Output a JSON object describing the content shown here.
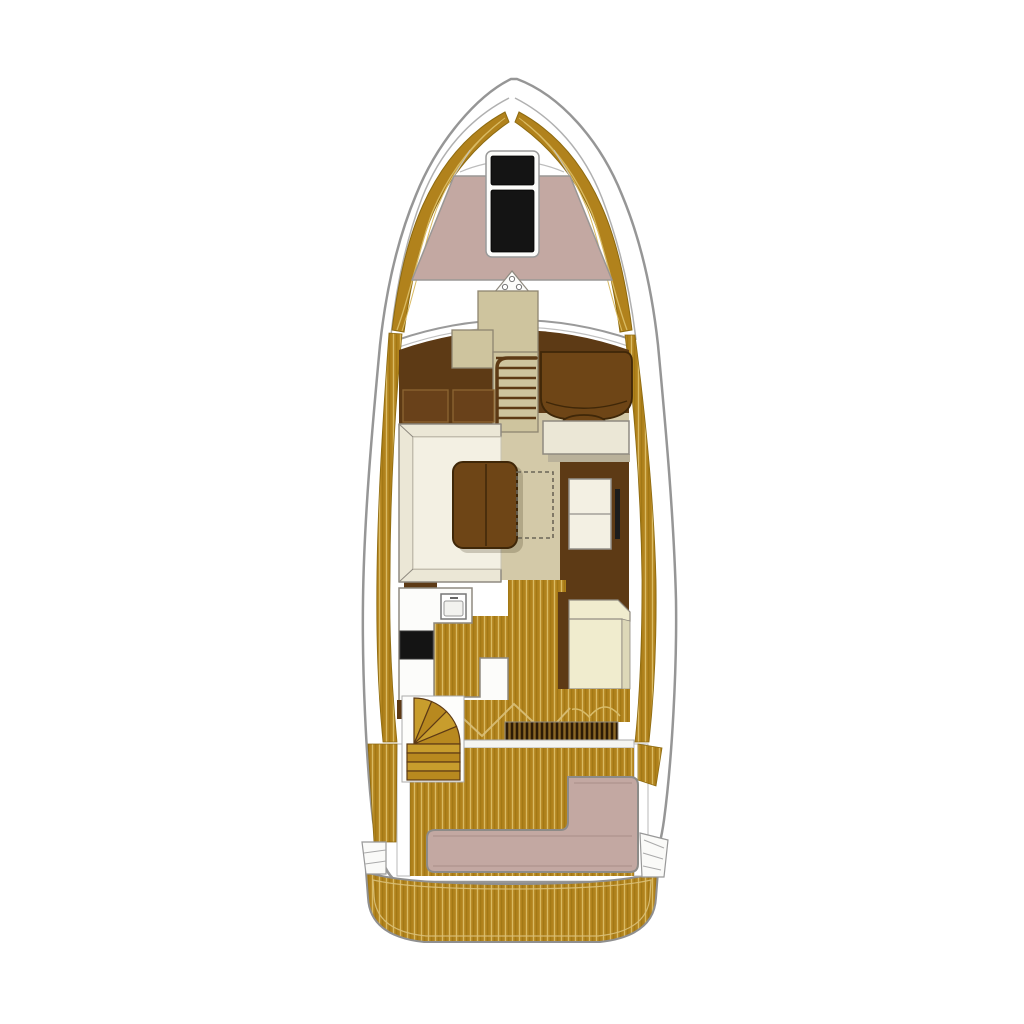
{
  "diagram": {
    "type": "yacht-deck-plan",
    "title": "Motor yacht top-view deck floor plan",
    "areas": {
      "foredeck": {
        "label": "Foredeck",
        "features": [
          "bow sunpad",
          "two deck hatches",
          "anchor deck fitting",
          "teak bow trim"
        ]
      },
      "helm": {
        "label": "Helm area",
        "features": [
          "helm seat with footrest",
          "companionway stairs to lower deck",
          "port cabinets",
          "console"
        ]
      },
      "salon": {
        "label": "Salon",
        "features": [
          "U-shaped sofa",
          "wooden table",
          "dashed table extension",
          "sideboard",
          "starboard bench seat"
        ]
      },
      "galley": {
        "label": "Galley",
        "features": [
          "counter with sink",
          "black cooktop",
          "island unit",
          "starboard chaise seat"
        ]
      },
      "cockpit": {
        "label": "Cockpit",
        "features": [
          "curved companion steps",
          "teak deck",
          "L-shaped stern bench",
          "engine vent grate"
        ]
      },
      "stern": {
        "label": "Stern",
        "features": [
          "teak swim platform",
          "port corner steps",
          "starboard corner steps"
        ]
      }
    }
  },
  "colors": {
    "hull": "#ffffff",
    "outline": "#969696",
    "teak": "#b1821c",
    "teak_stripe": "#d9ba62",
    "teak_dark_line": "#97700f",
    "sunpad": "#c3a8a2",
    "hatch": "#141414",
    "wood_dark": "#5d3a15",
    "furniture_brown": "#6e4516",
    "cabinet_brown": "#69411a",
    "beige_floor": "#d3c9a8",
    "console_beige": "#cec49e",
    "cream": "#ebe7d6",
    "cream_light": "#f3f0e3",
    "cream_seat": "#f0ecce",
    "grate_base": "#8a6626",
    "grate_line": "#2c1a06",
    "step_gold": "#c89d2d",
    "white_piece": "#fcfcfa"
  }
}
